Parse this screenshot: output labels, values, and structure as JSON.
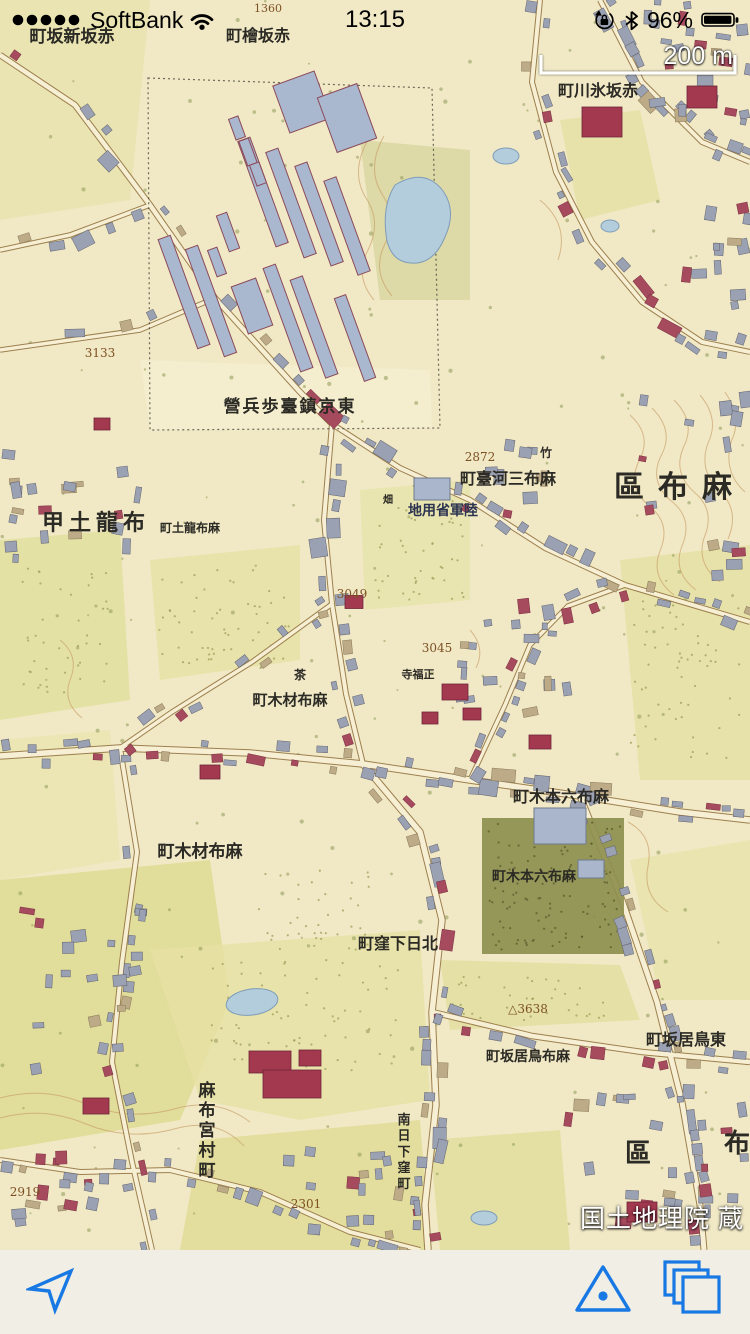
{
  "status_bar": {
    "carrier": "SoftBank",
    "signal_dots": 5,
    "time": "13:15",
    "battery_percent": "96%",
    "icons": [
      "signal-strength-icon",
      "wifi-icon",
      "orientation-lock-icon",
      "bluetooth-icon",
      "battery-icon"
    ]
  },
  "scale_bar": {
    "label": "200 m"
  },
  "attribution": {
    "text": "国土地理院 蔵"
  },
  "toolbar": {
    "accent_color": "#1878e4",
    "icons": [
      "location-arrow-icon",
      "triangulation-point-icon",
      "layers-icon"
    ]
  },
  "map": {
    "colors": {
      "paper": "#f1e9c6",
      "field": "#e0dc9e",
      "grove": "#8d8f4e",
      "water": "#b3cddd",
      "water_edge": "#7e9cb8",
      "building_gray": "#9aa1b2",
      "building_red": "#a64a5e",
      "building_tan": "#bdaa87",
      "barrack_blue": "#a9b7cf",
      "road_fill": "#f7efd3",
      "road_edge": "#9c7f4e",
      "contour": "#c79d66",
      "label": "#2b2a24",
      "number": "#7d5024"
    },
    "labels": [
      {
        "t": "町坂新坂赤",
        "x": 72,
        "y": 42,
        "s": 17
      },
      {
        "t": "1360",
        "x": 268,
        "y": 12,
        "s": 11,
        "num": true
      },
      {
        "t": "町檜坂赤",
        "x": 258,
        "y": 41,
        "s": 16
      },
      {
        "t": "町川氷坂赤",
        "x": 598,
        "y": 96,
        "s": 16
      },
      {
        "t": "3133",
        "x": 100,
        "y": 357,
        "s": 12,
        "num": true
      },
      {
        "t": "營兵歩臺鎮京東",
        "x": 290,
        "y": 412,
        "s": 17,
        "sp": 2
      },
      {
        "t": "2872",
        "x": 480,
        "y": 461,
        "s": 12,
        "num": true
      },
      {
        "t": "町臺河三布麻",
        "x": 508,
        "y": 484,
        "s": 16
      },
      {
        "t": "區布麻",
        "x": 680,
        "y": 497,
        "s": 30,
        "sp": 14
      },
      {
        "t": "地用省軍陸",
        "x": 443,
        "y": 515,
        "s": 14,
        "c": "#2c3450"
      },
      {
        "t": "甲土龍布",
        "x": 96,
        "y": 530,
        "s": 22,
        "sp": 5
      },
      {
        "t": "町土龍布麻",
        "x": 190,
        "y": 532,
        "s": 12
      },
      {
        "t": "竹",
        "x": 546,
        "y": 457,
        "s": 12
      },
      {
        "t": "畑",
        "x": 388,
        "y": 503,
        "s": 10
      },
      {
        "t": "茶",
        "x": 300,
        "y": 679,
        "s": 12
      },
      {
        "t": "3049",
        "x": 352,
        "y": 598,
        "s": 12,
        "num": true
      },
      {
        "t": "3045",
        "x": 437,
        "y": 652,
        "s": 12,
        "num": true
      },
      {
        "t": "寺福正",
        "x": 418,
        "y": 678,
        "s": 11
      },
      {
        "t": "町木材布麻",
        "x": 290,
        "y": 705,
        "s": 15
      },
      {
        "t": "町木本六布麻",
        "x": 561,
        "y": 802,
        "s": 16
      },
      {
        "t": "町木材布麻",
        "x": 200,
        "y": 857,
        "s": 17
      },
      {
        "t": "町木本六布麻",
        "x": 534,
        "y": 881,
        "s": 14
      },
      {
        "t": "町窪下日北",
        "x": 398,
        "y": 949,
        "s": 16
      },
      {
        "t": "△3638",
        "x": 528,
        "y": 1013,
        "s": 12,
        "num": true
      },
      {
        "t": "町坂居鳥布麻",
        "x": 528,
        "y": 1061,
        "s": 14
      },
      {
        "t": "町坂居鳥東",
        "x": 686,
        "y": 1045,
        "s": 16
      },
      {
        "t": "麻布宮村町",
        "x": 207,
        "y": 1096,
        "s": 17,
        "v": true
      },
      {
        "t": "南日下窪町",
        "x": 404,
        "y": 1124,
        "s": 13,
        "v": true
      },
      {
        "t": "2301",
        "x": 306,
        "y": 1208,
        "s": 12,
        "num": true
      },
      {
        "t": "2919",
        "x": 25,
        "y": 1196,
        "s": 12,
        "num": true
      },
      {
        "t": "區",
        "x": 638,
        "y": 1162,
        "s": 26
      },
      {
        "t": "布",
        "x": 737,
        "y": 1152,
        "s": 26
      }
    ]
  }
}
